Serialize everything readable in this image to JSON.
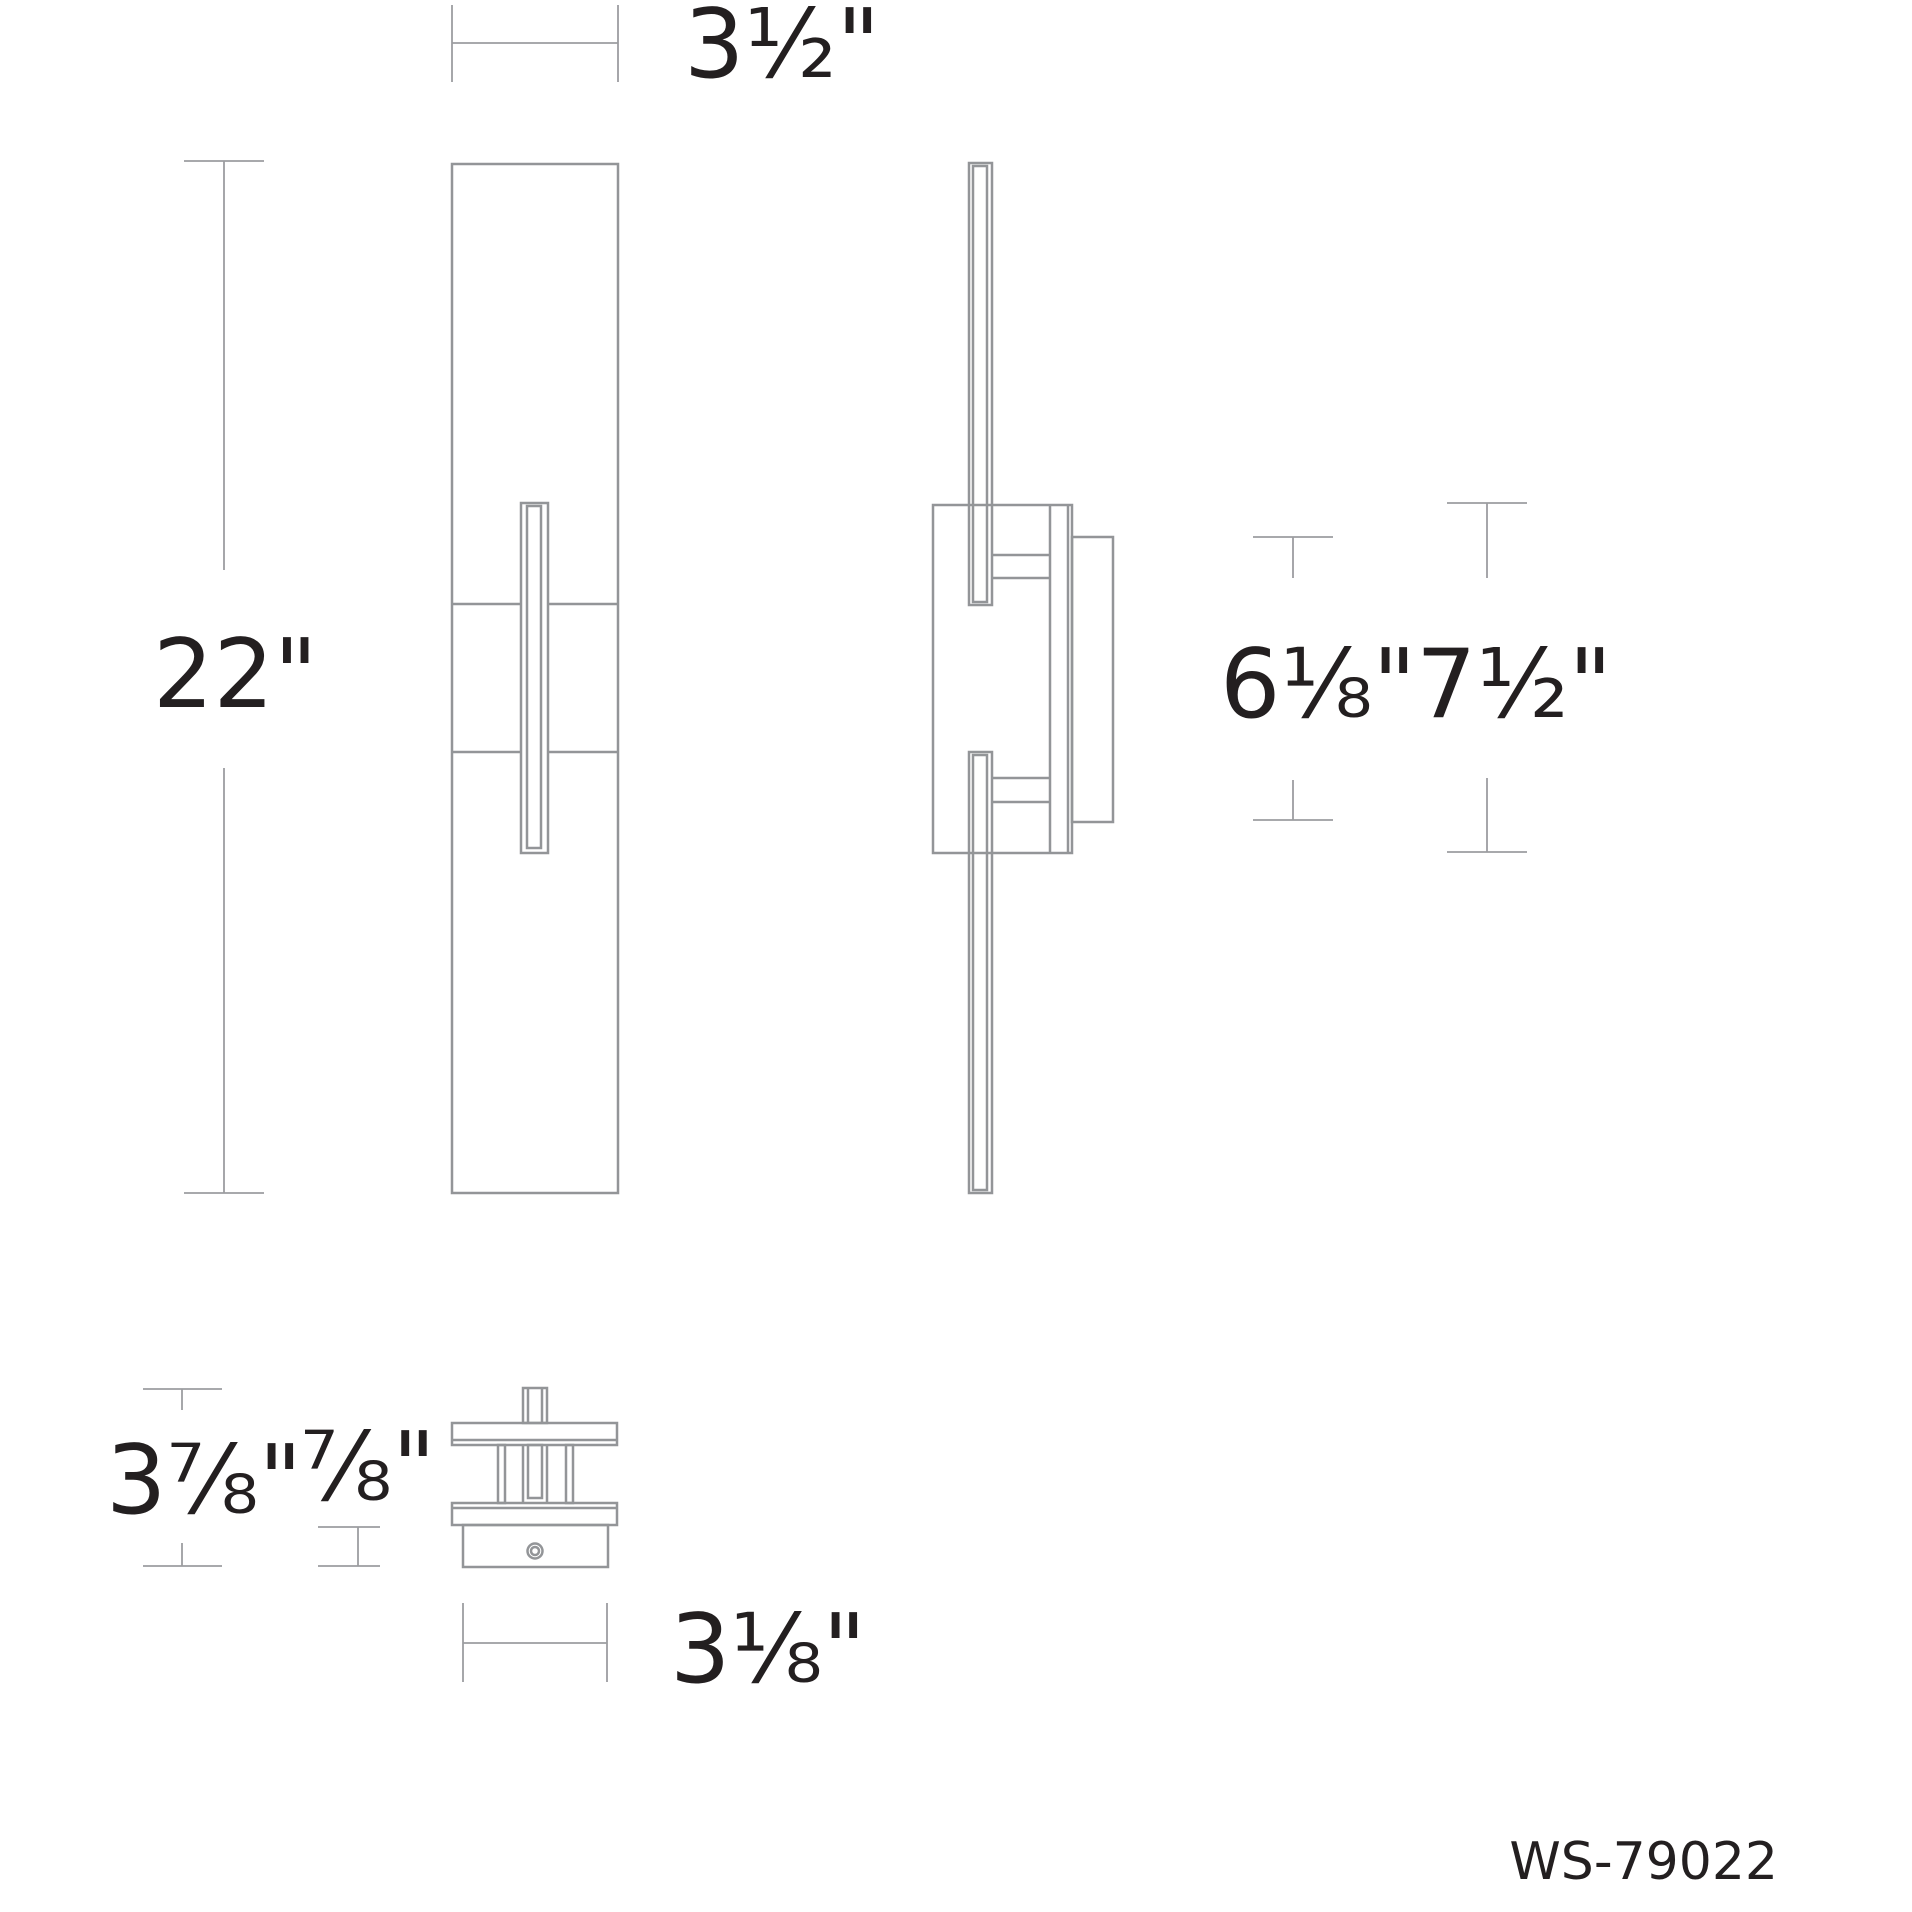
{
  "drawing": {
    "dimensions": {
      "front_width": "3½\"",
      "front_height": "22\"",
      "box_height": "6⅛\"",
      "plate_height": "7½\"",
      "top_view_height": "3⅞\"",
      "base_depth": "⅞\"",
      "base_width": "3⅛\""
    },
    "product_code": "WS-79022",
    "colors": {
      "line": "#939598",
      "dim_line": "#9c9da0",
      "text": "#231f20",
      "background": "#ffffff"
    }
  }
}
